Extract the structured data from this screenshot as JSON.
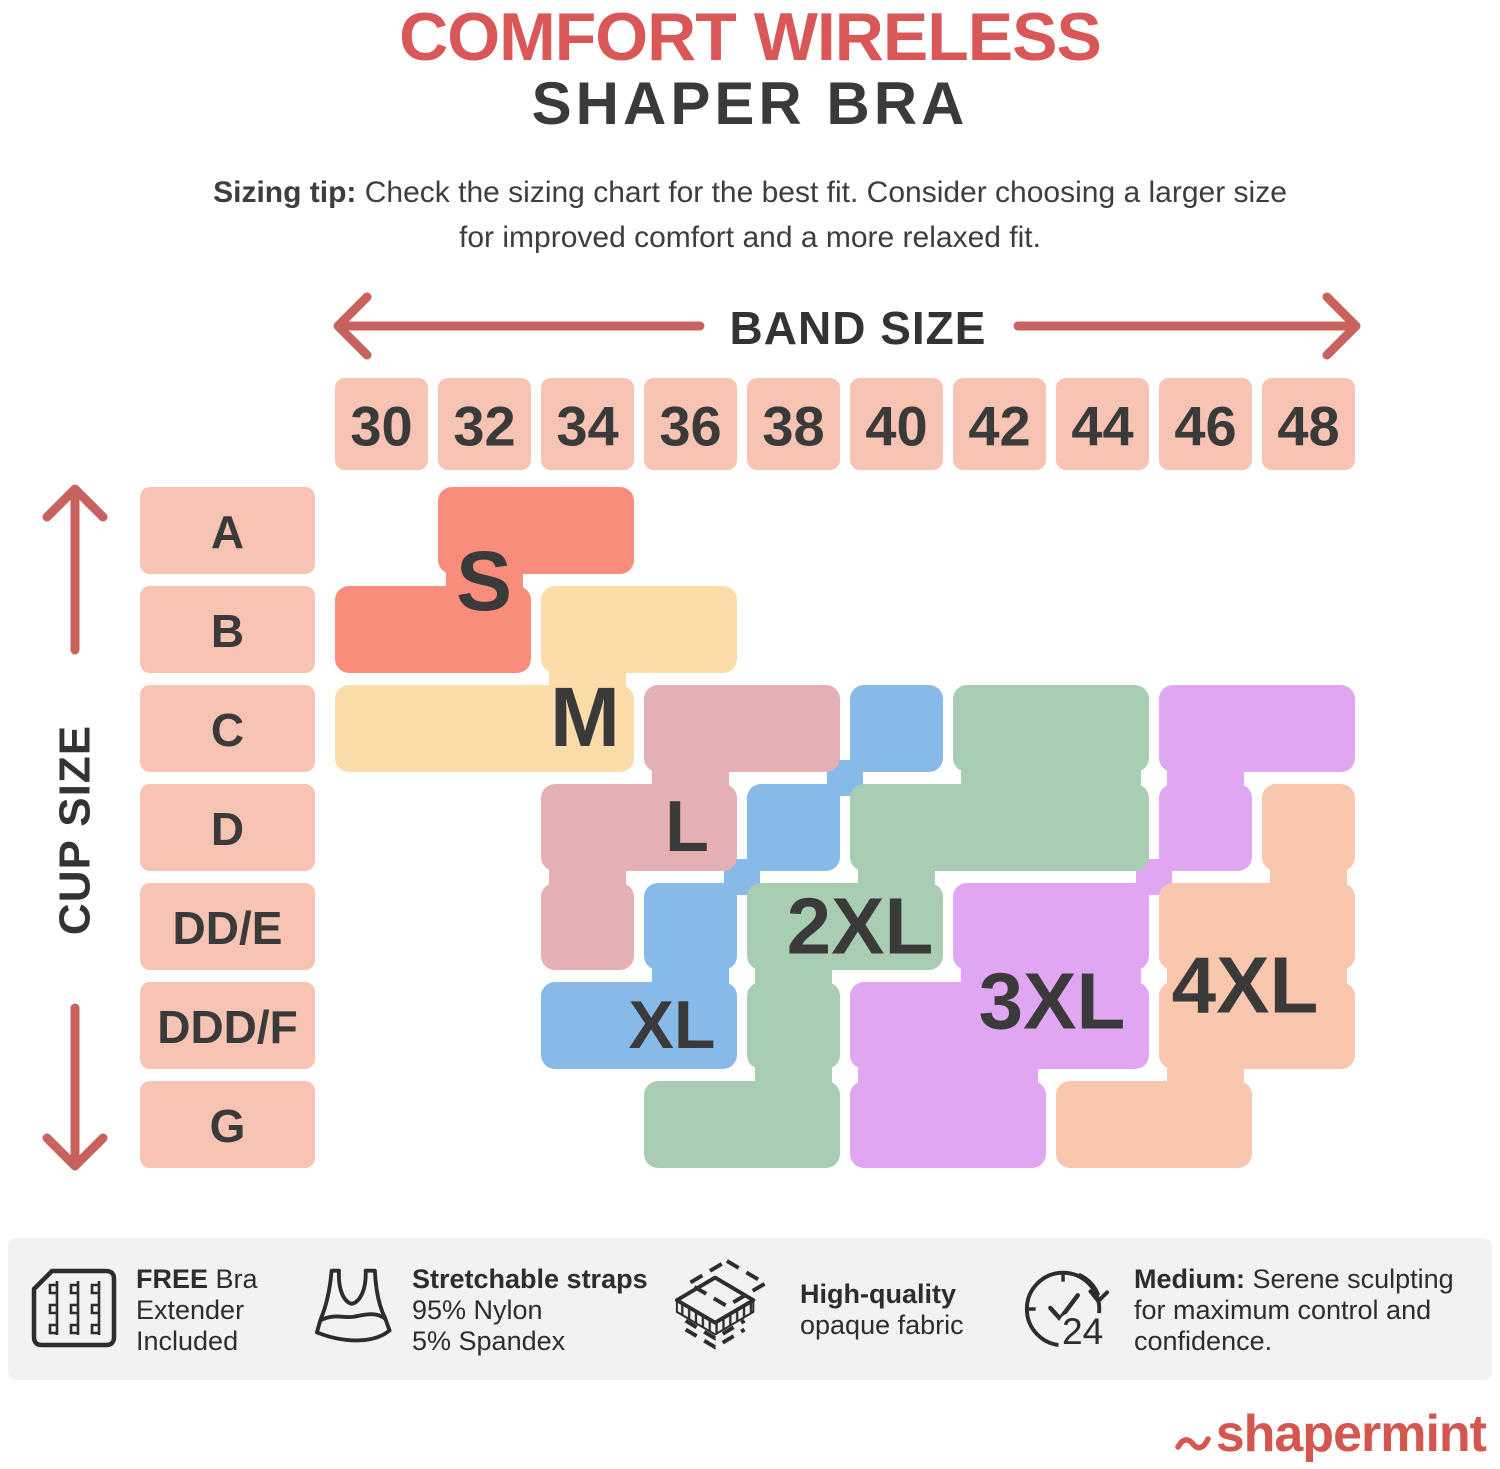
{
  "title": {
    "line1": "COMFORT WIRELESS",
    "line2": "SHAPER BRA",
    "line1_color": "#D95857",
    "line2_color": "#3A3A3C"
  },
  "sizing_tip": {
    "bold": "Sizing tip:",
    "line1_rest": " Check the sizing chart for the best fit. Consider choosing a larger size",
    "line2": "for improved comfort and a more relaxed fit."
  },
  "chart_data": {
    "type": "heatmap",
    "title": "Comfort Wireless Shaper Bra size chart",
    "band_axis_label": "BAND SIZE",
    "cup_axis_label": "CUP SIZE",
    "band_sizes": [
      "30",
      "32",
      "34",
      "36",
      "38",
      "40",
      "42",
      "44",
      "46",
      "48"
    ],
    "cup_sizes": [
      "A",
      "B",
      "C",
      "D",
      "DD/E",
      "DDD/F",
      "G"
    ],
    "header_cell_color": "#F7C3B3",
    "axis_arrow_color": "#C8625C",
    "label_color": "#3A3A3A",
    "sizes": [
      {
        "label": "S",
        "color": "#F98D7B",
        "label_px": [
          484,
          581
        ],
        "label_size": 84,
        "segments": [
          {
            "row": "A",
            "from": "32",
            "to": "34"
          },
          {
            "row": "B",
            "from": "30",
            "to": "32"
          }
        ]
      },
      {
        "label": "M",
        "color": "#FCDCA9",
        "label_px": [
          585,
          717
        ],
        "label_size": 84,
        "segments": [
          {
            "row": "B",
            "from": "34",
            "to": "36"
          },
          {
            "row": "C",
            "from": "30",
            "to": "34"
          }
        ]
      },
      {
        "label": "L",
        "color": "#E4B0B3",
        "label_px": [
          687,
          827
        ],
        "label_size": 72,
        "segments": [
          {
            "row": "C",
            "from": "36",
            "to": "38"
          },
          {
            "row": "D",
            "from": "34",
            "to": "36"
          },
          {
            "row": "DD/E",
            "from": "34",
            "to": "34"
          }
        ]
      },
      {
        "label": "XL",
        "color": "#87BAE9",
        "label_px": [
          672,
          1025
        ],
        "label_size": 68,
        "segments": [
          {
            "row": "C",
            "from": "40",
            "to": "40"
          },
          {
            "row": "D",
            "from": "38",
            "to": "38"
          },
          {
            "row": "DD/E",
            "from": "36",
            "to": "36"
          },
          {
            "row": "DDD/F",
            "from": "34",
            "to": "36"
          }
        ]
      },
      {
        "label": "2XL",
        "color": "#A8CDB2",
        "label_px": [
          860,
          926
        ],
        "label_size": 80,
        "segments": [
          {
            "row": "C",
            "from": "42",
            "to": "44"
          },
          {
            "row": "D",
            "from": "40",
            "to": "44"
          },
          {
            "row": "DD/E",
            "from": "38",
            "to": "40"
          },
          {
            "row": "DDD/F",
            "from": "38",
            "to": "38"
          },
          {
            "row": "G",
            "from": "36",
            "to": "38"
          }
        ]
      },
      {
        "label": "3XL",
        "color": "#E0A6F2",
        "label_px": [
          1052,
          1001
        ],
        "label_size": 80,
        "segments": [
          {
            "row": "C",
            "from": "46",
            "to": "48"
          },
          {
            "row": "D",
            "from": "46",
            "to": "46"
          },
          {
            "row": "DD/E",
            "from": "42",
            "to": "44"
          },
          {
            "row": "DDD/F",
            "from": "40",
            "to": "44"
          },
          {
            "row": "G",
            "from": "40",
            "to": "42"
          }
        ]
      },
      {
        "label": "4XL",
        "color": "#F9C6AE",
        "label_px": [
          1245,
          985
        ],
        "label_size": 80,
        "segments": [
          {
            "row": "D",
            "from": "48",
            "to": "48"
          },
          {
            "row": "DD/E",
            "from": "46",
            "to": "48"
          },
          {
            "row": "DDD/F",
            "from": "46",
            "to": "48"
          },
          {
            "row": "G",
            "from": "44",
            "to": "46"
          }
        ]
      }
    ]
  },
  "footer": {
    "bg": "#F2F2F2",
    "items": [
      {
        "icon": "bra-extender-icon",
        "lines": [
          {
            "b": "FREE",
            "t": " Bra"
          },
          {
            "b": "",
            "t": "Extender"
          },
          {
            "b": "",
            "t": "Included"
          }
        ]
      },
      {
        "icon": "bra-icon",
        "lines": [
          {
            "b": "Stretchable straps",
            "t": ""
          },
          {
            "b": "",
            "t": "95% Nylon"
          },
          {
            "b": "",
            "t": "5% Spandex"
          }
        ]
      },
      {
        "icon": "fabric-layers-icon",
        "lines": [
          {
            "b": "High-quality",
            "t": ""
          },
          {
            "b": "",
            "t": "opaque fabric"
          }
        ]
      },
      {
        "icon": "clock-24-icon",
        "lines": [
          {
            "b": "Medium:",
            "t": " Serene sculpting"
          },
          {
            "b": "",
            "t": "for maximum control and"
          },
          {
            "b": "",
            "t": "confidence."
          }
        ]
      }
    ]
  },
  "logo": {
    "text": "shapermint",
    "color": "#D3574E"
  }
}
